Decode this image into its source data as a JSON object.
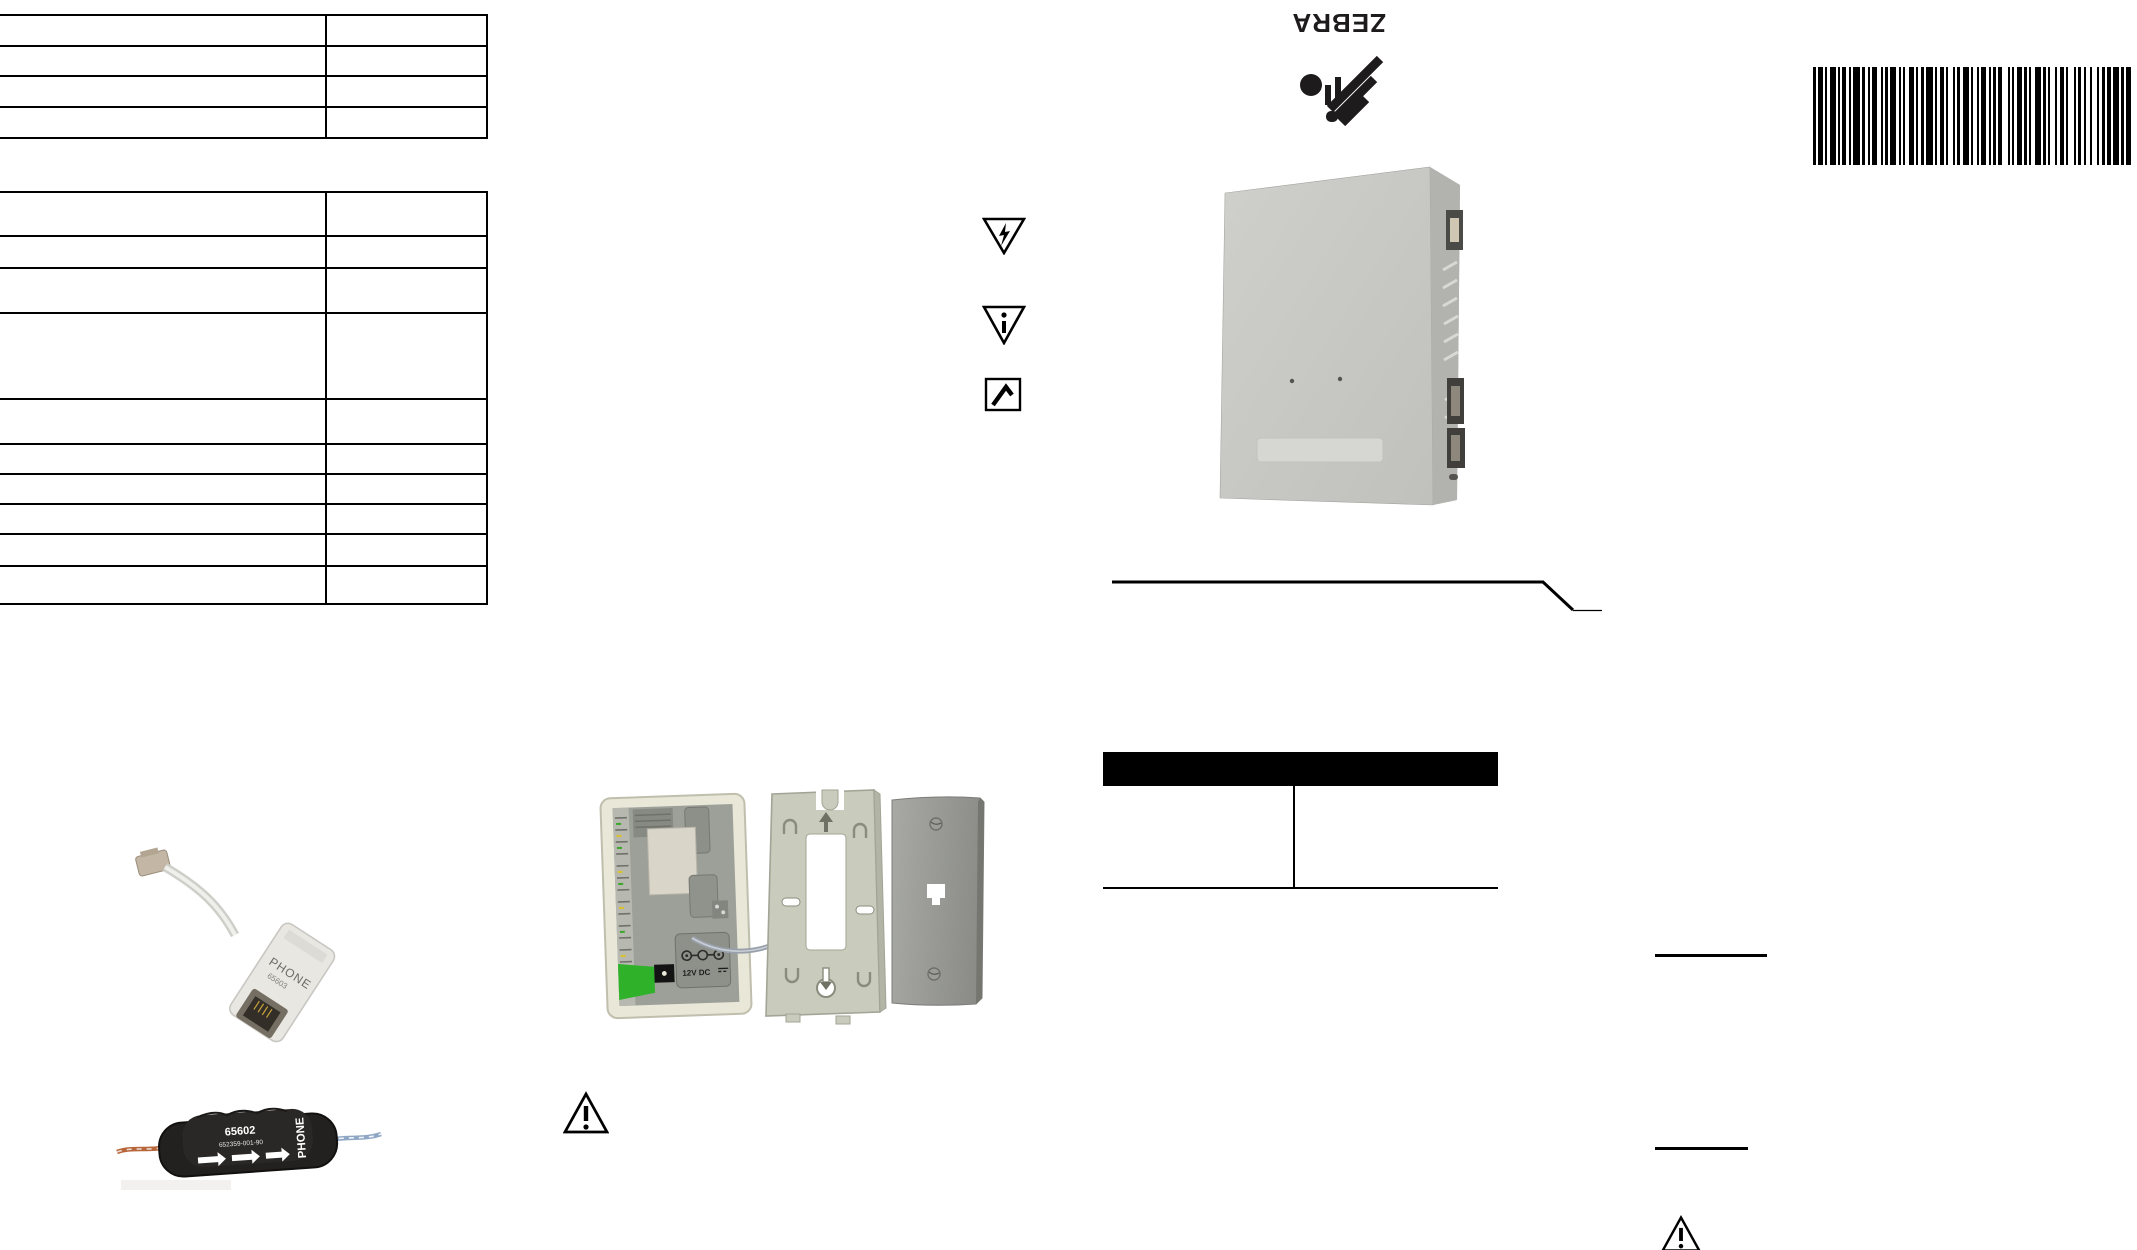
{
  "branding": {
    "wordmark": "ZEBRA"
  },
  "labels": {
    "power": "12V DC",
    "splitter_name": "PHONE",
    "splitter_part": "65603",
    "filter_part": "65602",
    "filter_code": "652359-001-90",
    "filter_port": "PHONE"
  },
  "tables": {
    "top": {
      "columns": 2,
      "rows": 4
    },
    "main": {
      "columns": 2,
      "rows": 10
    },
    "callout": {
      "columns": 2,
      "rows": 1
    }
  },
  "barcode": {
    "pattern": [
      3,
      2,
      5,
      2,
      2,
      3,
      6,
      2,
      2,
      2,
      4,
      3,
      2,
      2,
      7,
      2,
      3,
      3,
      2,
      2,
      5,
      4,
      2,
      2,
      3,
      2,
      6,
      3,
      2,
      2,
      2,
      4,
      5,
      2,
      2,
      3,
      3,
      2,
      7,
      2,
      2,
      3,
      4,
      2,
      2,
      5,
      2,
      2,
      3,
      3,
      6,
      2,
      2,
      4,
      2,
      2,
      5,
      3,
      2,
      2,
      3,
      2,
      4,
      6,
      2,
      2,
      2,
      3,
      5,
      2,
      3,
      2,
      2,
      4,
      6,
      2,
      3,
      2,
      2,
      5,
      2,
      3,
      4,
      2,
      2,
      6,
      2,
      2,
      3,
      3,
      2,
      4,
      2,
      5,
      2,
      3,
      3,
      2,
      4,
      2,
      6,
      2,
      3,
      2,
      5,
      2,
      2,
      3,
      4,
      2
    ]
  },
  "colors": {
    "ink": "#000000",
    "device_body": "#c8c8c4",
    "case_cream": "#e8e7d8",
    "pcb_green": "#2fb12a",
    "bracket": "#c9cbbc",
    "wall_plate": "#98998f",
    "filter_body": "#232120",
    "wire_orange": "#b8653a",
    "wire_blue": "#8fa7c4"
  }
}
